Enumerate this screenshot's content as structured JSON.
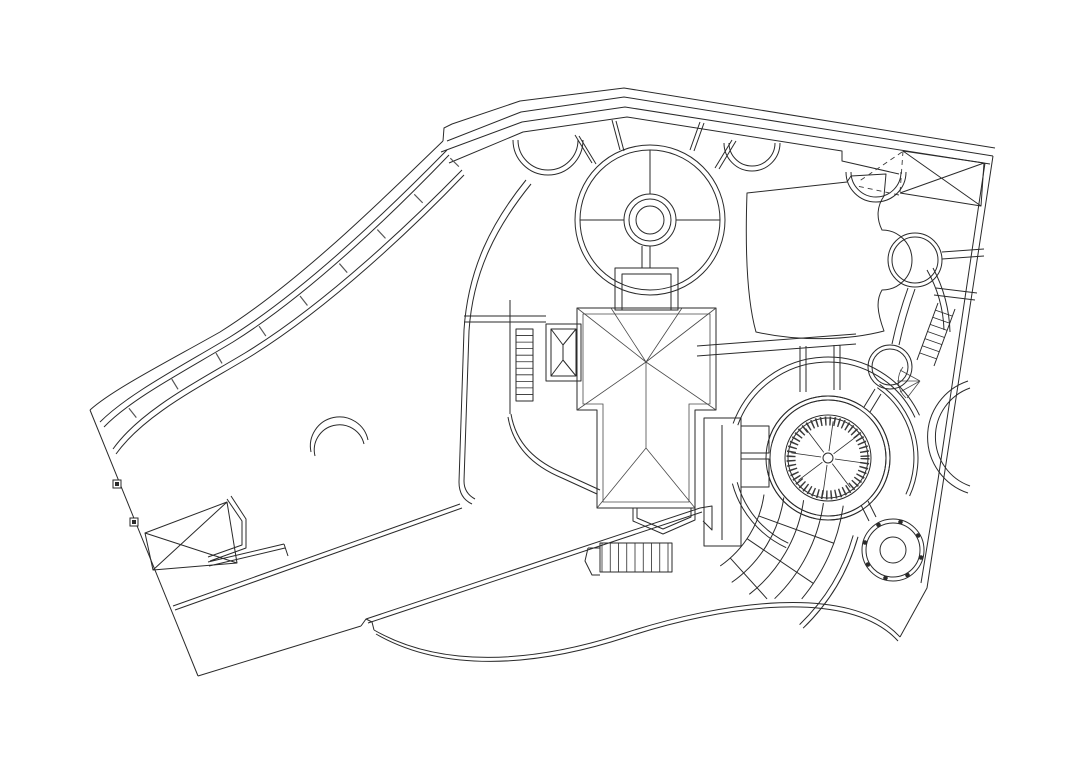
{
  "document": {
    "type": "architectural-site-plan",
    "description": "Black-and-white CAD line drawing of a villa site plan with gardens, circular fountain courts, driveways and terraces",
    "background": "#ffffff"
  },
  "style": {
    "line": "#2a2a2a",
    "fine_line": "#4a4a4a",
    "tick_color": "#3a3a3a"
  },
  "features": {
    "circles": [
      {
        "name": "top-garden-circle",
        "cx": 650,
        "cy": 220,
        "radii": [
          75,
          70,
          26,
          21,
          14
        ]
      },
      {
        "name": "lawn-round-planter",
        "cx": 915,
        "cy": 260,
        "radii": [
          27,
          23
        ]
      },
      {
        "name": "small-court-circle",
        "cx": 890,
        "cy": 367,
        "radii": [
          22,
          18
        ]
      },
      {
        "name": "fountain-circle",
        "cx": 828,
        "cy": 458,
        "radii": [
          62,
          58,
          43,
          40,
          5
        ]
      },
      {
        "name": "well-circle",
        "cx": 893,
        "cy": 550,
        "radii": [
          31,
          27,
          13
        ]
      }
    ],
    "fountain_tick_ring": {
      "cx": 828,
      "cy": 458,
      "r": 37,
      "width": 9,
      "dash": "1.5 3"
    },
    "fountain_star": {
      "cx": 828,
      "cy": 458,
      "r_inner": 7,
      "r_outer": 37,
      "count": 8,
      "angle_offset": 8
    },
    "fountain_arcs": {
      "cx": 828,
      "cy": 458,
      "radii": [
        58,
        62
      ],
      "segments": [
        [
          195,
          302
        ],
        [
          318,
          402
        ],
        [
          58,
          88
        ],
        [
          102,
          168
        ]
      ]
    },
    "fountain_outer_arcs": [
      {
        "cx": 828,
        "cy": 458,
        "radii": [
          96,
          101
        ],
        "seg": [
          200,
          335
        ]
      },
      {
        "cx": 828,
        "cy": 458,
        "radii": [
          94,
          99
        ],
        "seg": [
          115,
          165
        ]
      },
      {
        "cx": 828,
        "cy": 458,
        "radii": [
          86,
          90
        ],
        "seg": [
          305,
          385
        ]
      }
    ],
    "garden_cross": {
      "cx": 650,
      "cy": 220,
      "lines": [
        [
          650,
          150,
          650,
          194
        ],
        [
          580,
          220,
          624,
          220
        ],
        [
          676,
          220,
          720,
          220
        ],
        [
          642,
          246,
          642,
          268
        ],
        [
          650,
          246,
          650,
          268
        ]
      ]
    },
    "road_spokes": [
      [
        592,
        163,
        575,
        135
      ],
      [
        620,
        150,
        612,
        120
      ],
      [
        690,
        150,
        700,
        122
      ],
      [
        715,
        168,
        732,
        140
      ]
    ],
    "scallops": [
      {
        "cx": 548,
        "cy": 140,
        "radii": [
          35,
          30
        ]
      },
      {
        "cx": 752,
        "cy": 143,
        "radii": [
          28,
          23
        ]
      },
      {
        "cx": 876,
        "cy": 172,
        "radii": [
          30,
          25
        ]
      }
    ],
    "fan_steps": {
      "cx": 660,
      "cy": 480,
      "arcs": [
        {
          "r": 105,
          "a": [
            8,
            55
          ]
        },
        {
          "r": 125,
          "a": [
            8,
            55
          ]
        },
        {
          "r": 145,
          "a": [
            8,
            52
          ]
        },
        {
          "r": 165,
          "a": [
            8,
            46
          ]
        },
        {
          "r": 185,
          "a": [
            8,
            40
          ]
        }
      ],
      "dividers": [
        [
          20,
          105,
          185
        ],
        [
          34,
          105,
          185
        ],
        [
          48,
          105,
          160
        ]
      ],
      "edge": {
        "radii": [
          201,
          206
        ],
        "a": [
          16,
          46
        ]
      }
    },
    "well_dots": {
      "cx": 893,
      "cy": 550,
      "ring": 29,
      "count": 8,
      "dot_r": 2.3,
      "start": 15
    },
    "fence_posts": [
      {
        "x": 117,
        "y": 484
      },
      {
        "x": 134,
        "y": 522
      }
    ],
    "deck_ladder": {
      "x": 516,
      "y": 329,
      "w": 17,
      "h": 72,
      "rungs": 10
    },
    "stair_treads": {
      "x1": 602,
      "x2": 668,
      "y1": 543,
      "y2": 572,
      "count": 9
    },
    "right_ladder": {
      "x1": 938,
      "y1": 303,
      "x2": 917,
      "y2": 360,
      "dx": 17,
      "dy": 6,
      "count": 7
    }
  }
}
